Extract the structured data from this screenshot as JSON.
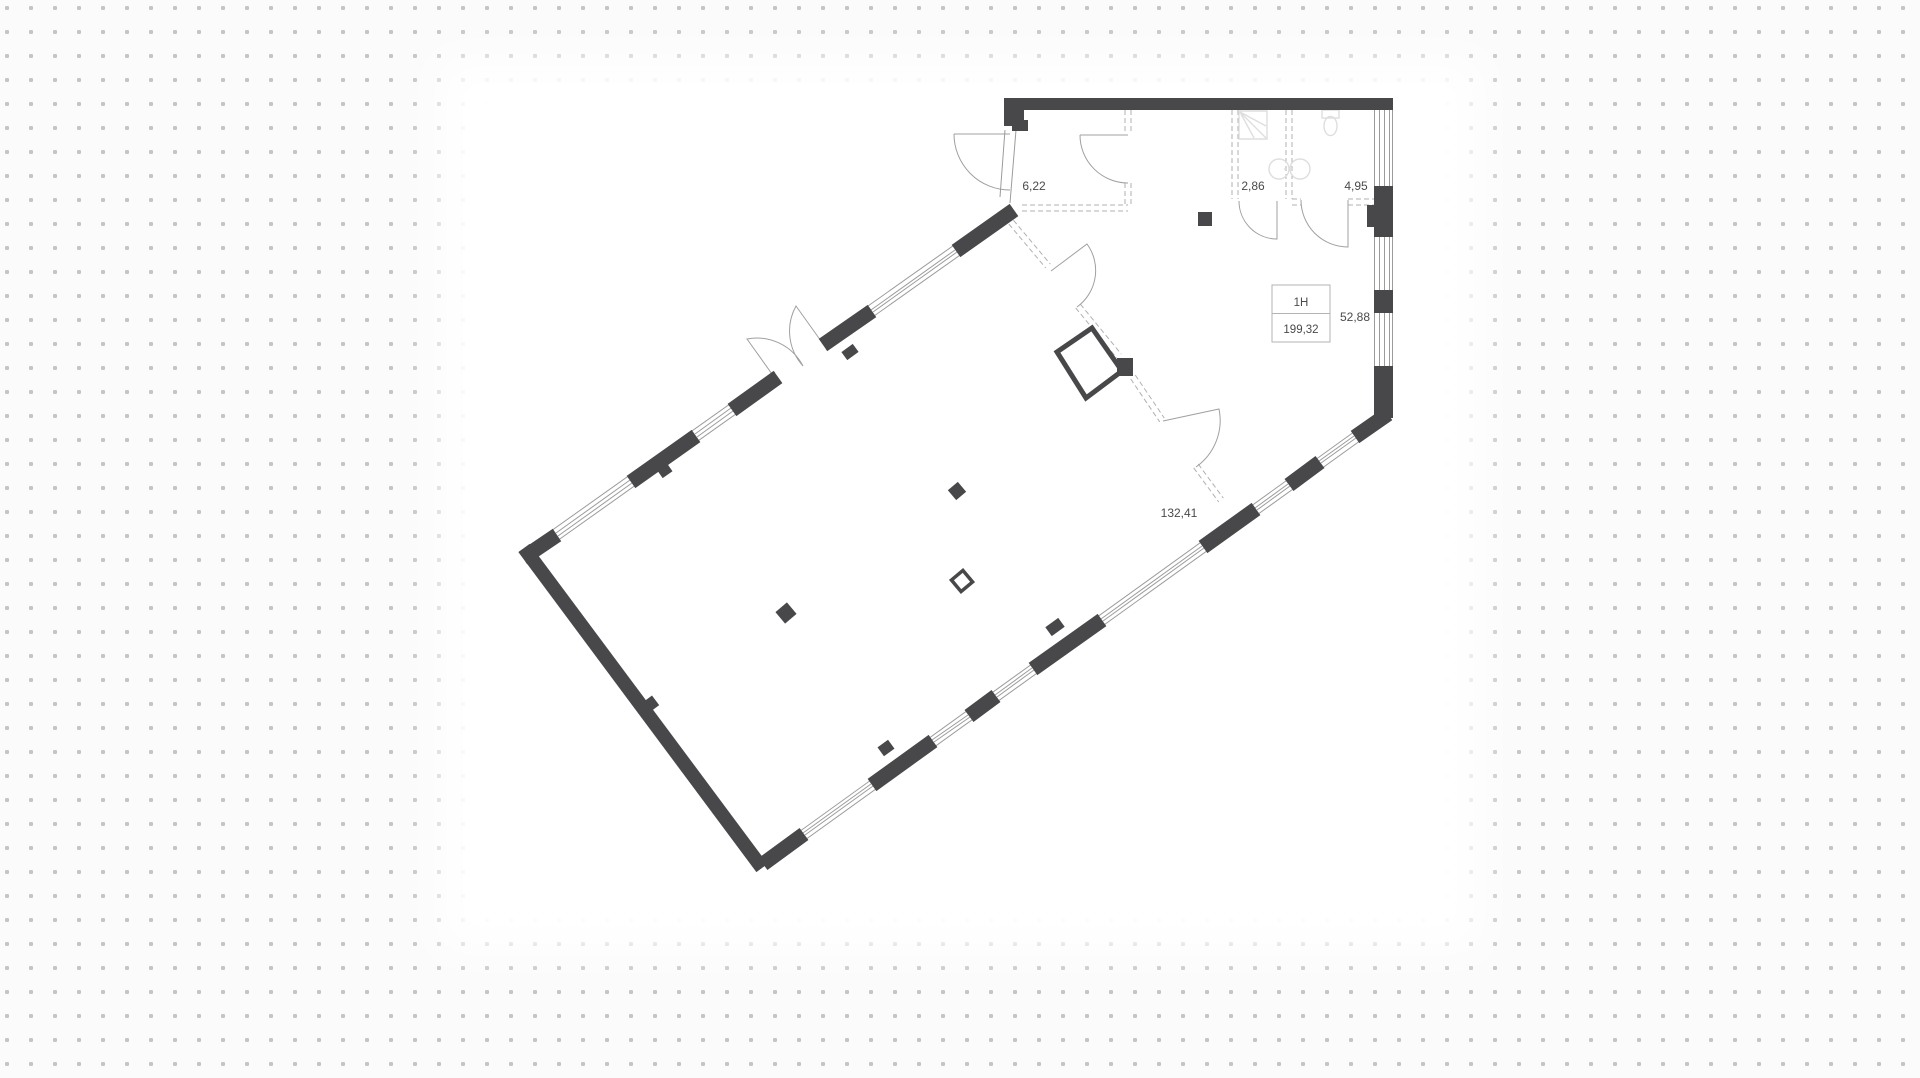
{
  "plan": {
    "unit": {
      "label": "1H",
      "total_area": "199,32"
    },
    "areas": {
      "vestibule": "6,22",
      "wc_small": "2,86",
      "wc_large": "4,95",
      "hall": "52,88",
      "main_room": "132,41"
    }
  },
  "colors": {
    "wall": "#48484b",
    "line": "#9b9b9b",
    "door": "#a0a0a0",
    "dash": "#b0b0b0",
    "fixture": "#dedede",
    "text": "#4a4a4a",
    "dot": "#c6c6c6",
    "background": "#fbfbfb",
    "halo": "#ffffff",
    "floor": "#ffffff"
  }
}
